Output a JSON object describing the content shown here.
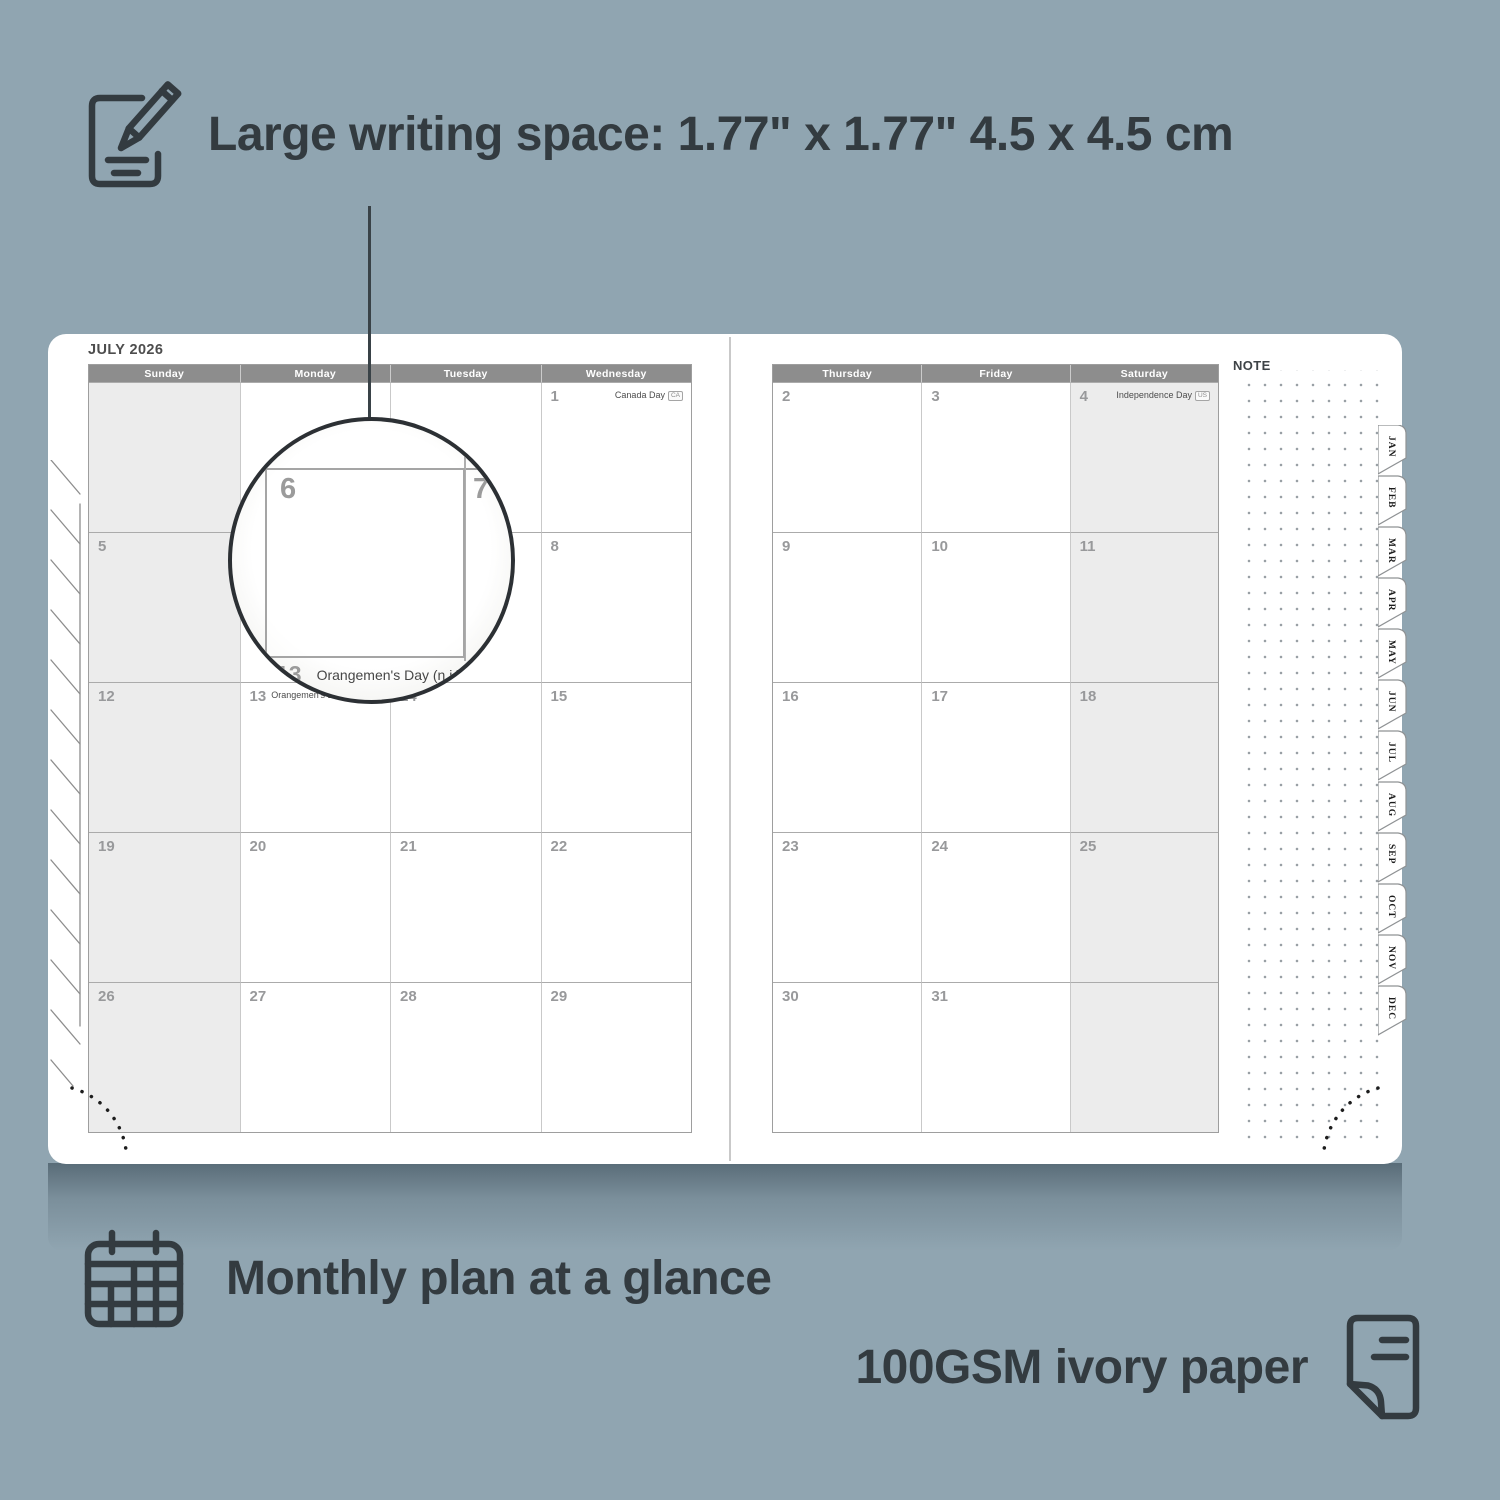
{
  "colors": {
    "background": "#90a5b1",
    "ink": "#333b40",
    "header_band": "#8d8d8d",
    "shaded_cell": "#ececec",
    "page": "#ffffff"
  },
  "annotations": {
    "writing_space_label": "Large writing space: 1.77\" x 1.77\" 4.5 x 4.5 cm",
    "monthly_plan_label": "Monthly plan at a glance",
    "paper_label": "100GSM ivory paper"
  },
  "icons": [
    "notepad-pencil-icon",
    "calendar-grid-icon",
    "paper-sheet-icon"
  ],
  "planner": {
    "month_title": "JULY 2026",
    "note_label": "NOTE",
    "left_day_headers": [
      "Sunday",
      "Monday",
      "Tuesday",
      "Wednesday"
    ],
    "right_day_headers": [
      "Thursday",
      "Friday",
      "Saturday"
    ],
    "tabs": [
      "JAN",
      "FEB",
      "MAR",
      "APR",
      "MAY",
      "JUN",
      "JUL",
      "AUG",
      "SEP",
      "OCT",
      "NOV",
      "DEC"
    ],
    "left_weeks": [
      [
        {},
        {},
        {},
        {
          "d": "1",
          "h": "Canada Day",
          "b": "CA"
        }
      ],
      [
        {
          "d": "5"
        },
        {
          "d": "6"
        },
        {
          "d": "7"
        },
        {
          "d": "8"
        }
      ],
      [
        {
          "d": "12"
        },
        {
          "d": "13",
          "h": "Orangemen's Day (n.i.)",
          "b": "UK"
        },
        {
          "d": "14"
        },
        {
          "d": "15"
        }
      ],
      [
        {
          "d": "19"
        },
        {
          "d": "20"
        },
        {
          "d": "21"
        },
        {
          "d": "22"
        }
      ],
      [
        {
          "d": "26"
        },
        {
          "d": "27"
        },
        {
          "d": "28"
        },
        {
          "d": "29"
        }
      ]
    ],
    "right_weeks": [
      [
        {
          "d": "2"
        },
        {
          "d": "3"
        },
        {
          "d": "4",
          "h": "Independence Day",
          "b": "US"
        }
      ],
      [
        {
          "d": "9"
        },
        {
          "d": "10"
        },
        {
          "d": "11"
        }
      ],
      [
        {
          "d": "16"
        },
        {
          "d": "17"
        },
        {
          "d": "18"
        }
      ],
      [
        {
          "d": "23"
        },
        {
          "d": "24"
        },
        {
          "d": "25"
        }
      ],
      [
        {
          "d": "30"
        },
        {
          "d": "31"
        },
        {}
      ]
    ]
  },
  "magnifier": {
    "cell_left_day": "6",
    "cell_right_day": "7",
    "footer_day": "13",
    "footer_holiday": "Orangemen's Day (n.i.)",
    "footer_badge": "UK"
  }
}
